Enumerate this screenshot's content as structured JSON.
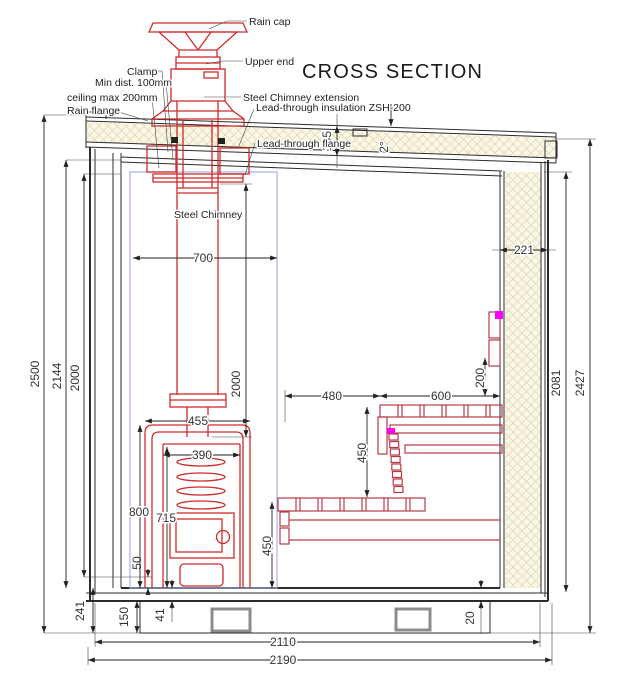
{
  "title": "CROSS SECTION",
  "labels": {
    "rain_cap": "Rain cap",
    "upper_end": "Upper end",
    "clamp": "Clamp",
    "min_dist": "Min dist. 100mm",
    "ceiling_max": "ceiling max 200mm",
    "rain_flange": "Rain flange",
    "chimney_extension": "Steel Chimney extension",
    "lead_through_insulation": "Lead-through insulation ZSH-200",
    "lead_through_flange": "Lead-through flange",
    "steel_chimney": "Steel Chimney"
  },
  "dims": {
    "overall_height": "2500",
    "interior_height": "2144",
    "inner_height": "2000",
    "chimney_zone_width": "700",
    "chimney_length": "2000",
    "roof_thickness": "165",
    "roof_slope": "2°",
    "right_wall_thickness": "221",
    "right_inner_height": "2081",
    "right_overall_height": "2427",
    "stove_top_width": "455",
    "firebox_width": "390",
    "stove_height": "800",
    "stove_inner_height": "715",
    "stove_clearance": "50",
    "stove_bench_gap": "480",
    "bench_depth": "600",
    "backrest_offset": "200",
    "bench_rise": "450",
    "lower_bench_height": "450",
    "foundation_height": "241",
    "floor_height": "150",
    "floor_slab": "41",
    "wall_gap": "20",
    "interior_width": "2110",
    "overall_width": "2190"
  },
  "colors": {
    "chimney_red": "#cf2b2b",
    "bench_red": "#b83a48",
    "magenta_marker": "#ff00ff",
    "safety_zone_blue": "#a9b2e6",
    "insulation_cream": "#fbf8ea",
    "insulation_hatch": "#e2dbae",
    "foundation_gray": "#8c8c8c",
    "line_black": "#2b2b2b"
  }
}
